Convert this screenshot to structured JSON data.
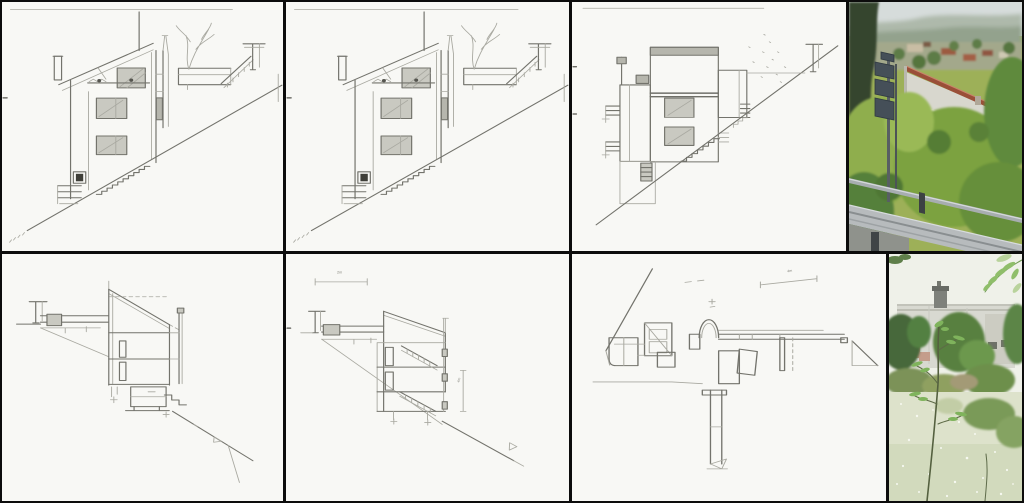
{
  "figure": {
    "kind": "architectural-study-collage",
    "grid": {
      "rows": 2,
      "columns": 4
    },
    "panels": [
      {
        "id": "elevation-sketch-1",
        "media": "pencil-sketch",
        "subject": "section-elevation, hillside house with exterior stair"
      },
      {
        "id": "elevation-sketch-2",
        "media": "pencil-sketch",
        "subject": "section-elevation, hillside house with exterior stair"
      },
      {
        "id": "elevation-sketch-3",
        "media": "pencil-sketch",
        "subject": "elevation with hatched roof slab on slope"
      },
      {
        "id": "site-photo-upper",
        "media": "photo",
        "subject": "white house with red roof edge on wooded hillside, road guardrail in foreground"
      },
      {
        "id": "section-sketch-1",
        "media": "pencil-sketch",
        "subject": "building cross-section on sloping ground"
      },
      {
        "id": "section-sketch-2",
        "media": "pencil-sketch",
        "subject": "dimensioned cross-section with internal stairs"
      },
      {
        "id": "plan-sketch",
        "media": "pencil-sketch",
        "subject": "floor plan with semicircular stair and long ramp"
      },
      {
        "id": "site-photo-lower",
        "media": "photo",
        "subject": "pale house with chimney behind vegetation and young sapling"
      }
    ],
    "annotations": {
      "dim_horizontal": "2m",
      "dim_vertical": "4m",
      "dim_plan": "4m"
    }
  },
  "palette": {
    "frame": "#0c0c0c",
    "paper": "#f8f8f5",
    "pencil": "#73736c",
    "photo_sky": "#d6dcdb",
    "photo_hills": "#93a28d",
    "photo_foliage": "#7ca23f",
    "photo_roof": "#9a4f38",
    "photo_wall": "#d8d7ce",
    "photo_guardrail": "#b7bbbd",
    "photo_sign": "#454f58",
    "photo2_sky": "#eff1e9",
    "photo2_wall": "#d8d9d1",
    "photo2_grass": "#dde2cb"
  }
}
